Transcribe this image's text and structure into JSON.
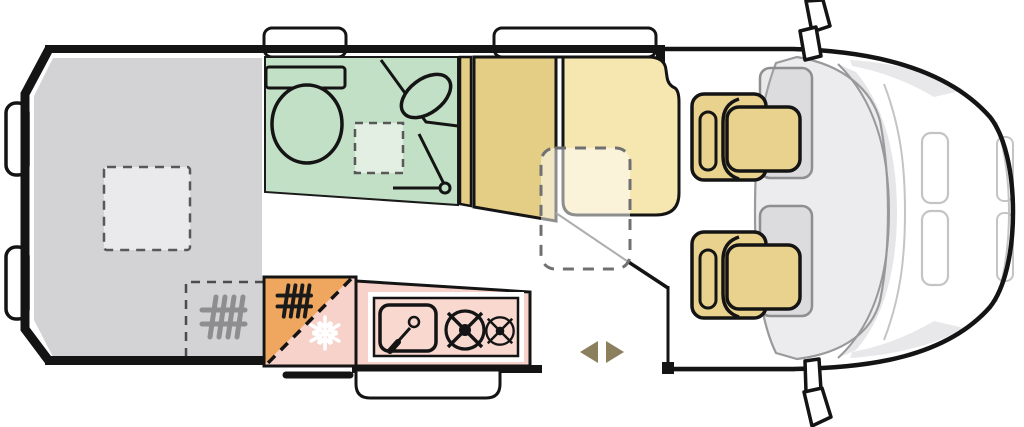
{
  "diagram": {
    "type": "motorhome-floorplan-top-view",
    "colors": {
      "bed": "#d3d3d5",
      "vent": "#eaeaec",
      "bathroom": "#c2e0c6",
      "shower": "#e3efe2",
      "wardrobe": "#e4cd84",
      "bench": "#f5e7af",
      "table": "rgba(255,255,255,0.52)",
      "seat": "#e9d28e",
      "ghost": "rgba(180,180,182,0.28)",
      "kitchen": "#f7d2ca",
      "kitchen_inner": "#f9d8d0",
      "heater_orange": "#efa65f",
      "arrow": "#8c7f5e",
      "heater_gray": "#8e8e90",
      "heater_black": "#1a1a1a",
      "outline": "#141414",
      "dashboard": "#ececee",
      "glass": "#e6e6e8",
      "shade": "#e8e8ea",
      "white": "#ffffff"
    },
    "regions": [
      {
        "id": "rear-bed",
        "label": "transverse rear bed"
      },
      {
        "id": "roof-vent",
        "label": "roof vent (dashed)"
      },
      {
        "id": "underbed-heater-zone",
        "label": "heater zone under bed (dashed)"
      },
      {
        "id": "bathroom",
        "label": "washroom"
      },
      {
        "id": "toilet",
        "label": "toilet"
      },
      {
        "id": "washbasin",
        "label": "corner washbasin"
      },
      {
        "id": "shower-tray",
        "label": "shower tray (dashed)"
      },
      {
        "id": "bathroom-door-swing",
        "label": "door swing"
      },
      {
        "id": "wardrobe",
        "label": "wardrobe"
      },
      {
        "id": "dinette-bench",
        "label": "dinette bench"
      },
      {
        "id": "table",
        "label": "removable table (dashed)"
      },
      {
        "id": "fridge",
        "label": "compressor fridge"
      },
      {
        "id": "heater",
        "label": "heater"
      },
      {
        "id": "kitchen-block",
        "label": "kitchen unit"
      },
      {
        "id": "sink",
        "label": "kitchen sink"
      },
      {
        "id": "hob",
        "label": "two-burner hob"
      },
      {
        "id": "sliding-door",
        "label": "sliding entry door"
      },
      {
        "id": "entry-step",
        "label": "entry step"
      },
      {
        "id": "driver-seat",
        "label": "swivel cab seat"
      },
      {
        "id": "passenger-seat",
        "label": "swivel cab seat"
      },
      {
        "id": "dashboard",
        "label": "cab dashboard"
      },
      {
        "id": "windscreen",
        "label": "windscreen"
      },
      {
        "id": "wing-mirror-top",
        "label": "wing mirror"
      },
      {
        "id": "wing-mirror-bottom",
        "label": "wing mirror"
      },
      {
        "id": "rear-door-handles",
        "label": "rear door handles"
      },
      {
        "id": "window-bathroom",
        "label": "side window"
      },
      {
        "id": "window-dinette",
        "label": "side window"
      }
    ]
  }
}
